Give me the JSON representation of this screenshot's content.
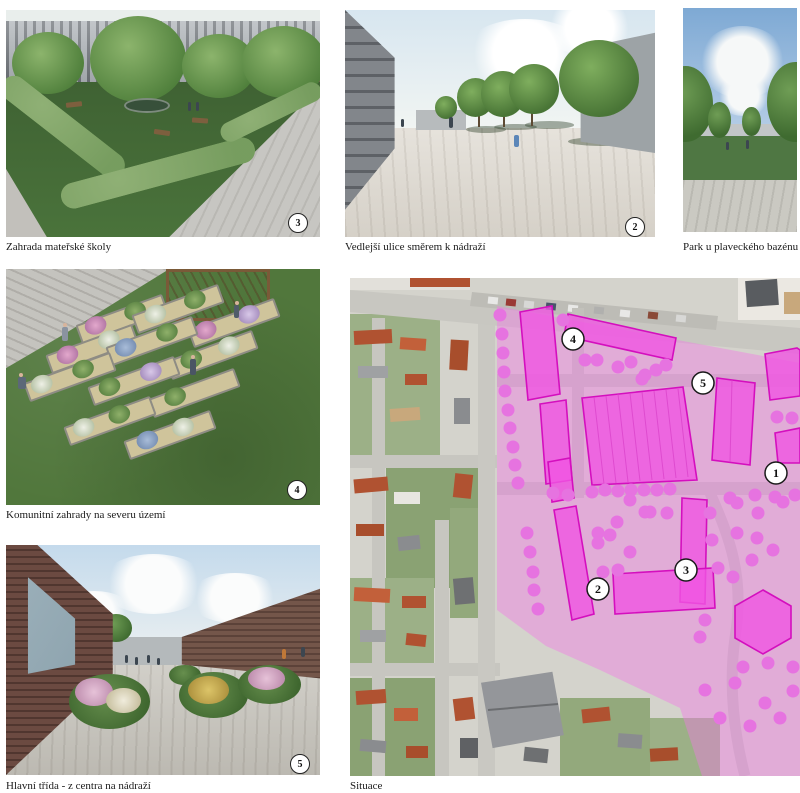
{
  "board": {
    "background": "#ffffff",
    "caption_color": "#1a1a1a"
  },
  "panels": [
    {
      "id": "kindergarten-garden",
      "caption": "Zahrada mateřské školy",
      "badge": "3"
    },
    {
      "id": "side-street",
      "caption": "Vedlejší ulice směrem k nádraží",
      "badge": "2"
    },
    {
      "id": "pool-park",
      "caption": "Park u plaveckého bazénu"
    },
    {
      "id": "community-gardens",
      "caption": "Komunitní zahrady na severu území",
      "badge": "4"
    },
    {
      "id": "main-street",
      "caption": "Hlavní třída - z centra na nádraží",
      "badge": "5"
    },
    {
      "id": "site-plan",
      "caption": "Situace"
    }
  ],
  "site_plan": {
    "badges": [
      {
        "label": "1"
      },
      {
        "label": "2"
      },
      {
        "label": "3"
      },
      {
        "label": "4"
      },
      {
        "label": "5"
      }
    ],
    "colors": {
      "overlay_pink": "#f478e8",
      "building_fill": "#f055e2",
      "building_stroke": "#d40fbe",
      "tree_dot": "#e673e0",
      "badge_background": "#ffffff",
      "badge_border": "#1a1a1a"
    }
  }
}
